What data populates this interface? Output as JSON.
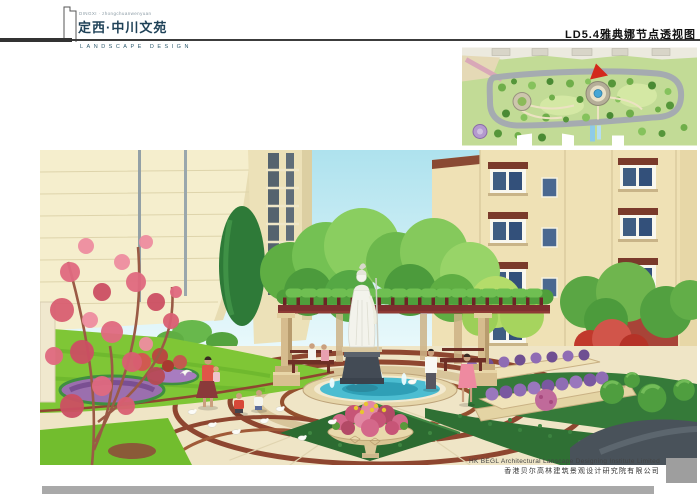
{
  "header": {
    "tagline": "DINGXI · zhongchuanwenyuan",
    "project_title": "定西·中川文苑",
    "subtitle": "LANDSCAPE DESIGN",
    "sheet_title": "LD5.4雅典娜节点透视图"
  },
  "footer": {
    "company_en": "HK BEGL Architectural Lanscape Designing Institute Limited",
    "company_cn": "香港贝尔高林建筑景观设计研究院有限公司"
  },
  "colors": {
    "title_accent": "#1f4258",
    "rule": "#3c3c3c",
    "footer_bar": "#a9a9a9",
    "plan_marker_red": "#d3281c",
    "sky": "#aee2ee",
    "building_beige": "#efe1b5",
    "lawn_green": "#7fc636",
    "pergola_red": "#7e2f2f",
    "fountain_water": "#4cbdd1",
    "flower_purple": "#9b6fae",
    "flower_pink": "#d4688a"
  }
}
